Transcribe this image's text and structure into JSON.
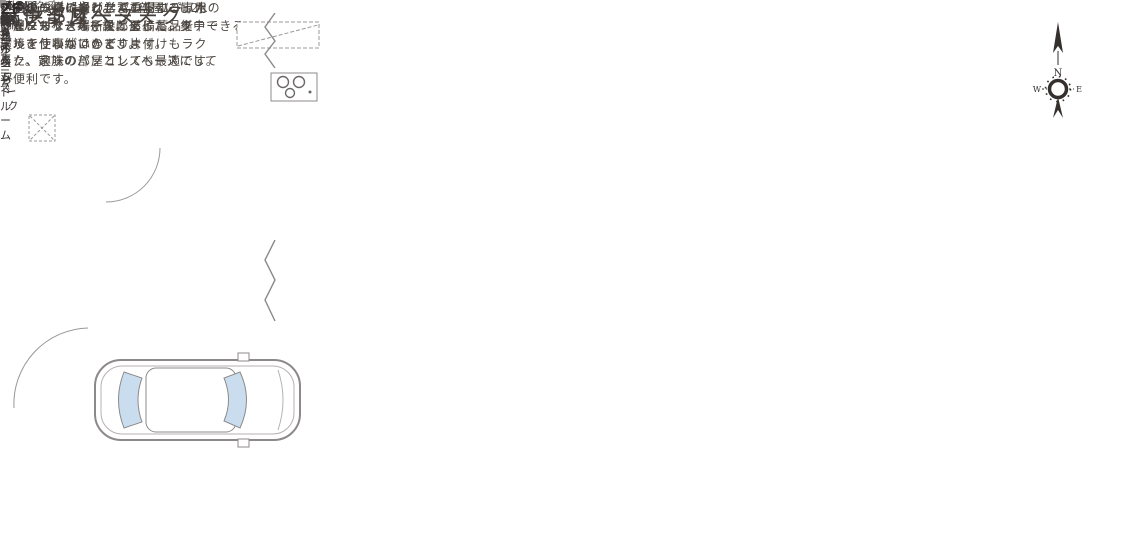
{
  "annotations": {
    "pantry": {
      "title": "パントリー",
      "desc": "キッチン横に設けたパントリー。水\nやビールなど場所をとる備蓄品を\nすっきり収納できます。"
    },
    "family_nook": {
      "title": "ファミリーヌーク",
      "desc": "お子様のリビング学習の場にぴった\nりなヌークスペース。ダイニングテー\nブルを使わないので、片付けもラク\nラク。家族のパソコンスペースにして\nも便利です。"
    },
    "kids_room": {
      "title": "子供部屋",
      "desc": "子供の成長に合わせて1部屋にも2\n部屋にもできる子供部屋。"
    },
    "workspace": {
      "title": "ワークスペース",
      "desc": "在宅ワークの場として重宝する専用の\nワークスペースを設けました。集中できる\n環境で仕事がはかどります。\nまた、趣味の部屋としても最適です。"
    }
  },
  "floor1": {
    "floor_label": "1F",
    "bathroom": "バスルーム",
    "storage_pantry": "収納",
    "storage_top": "収納",
    "storage_mid": "収納",
    "powder_room": "パウダー\nルーム",
    "toilet": "トイレ",
    "hall": "ホール",
    "up": "UP",
    "entrance": "玄関",
    "shoe_cloak": "シューズクローク",
    "ldk": "LDK",
    "ldk_size": "(14.6帖)",
    "family_nook": "ファミリー\nヌーク"
  },
  "floor2": {
    "floor_label": "2F",
    "workspace": "ワーク\nスペース",
    "toilet": "トイレ",
    "down": "DN",
    "wcl": "WCL",
    "wcl_size": "(3.5帖)",
    "bedroom_north": "ベッドルーム",
    "bedroom_north_size": "(5帖)",
    "closet_north": "CL",
    "bedroom_south": "ベッドルーム",
    "bedroom_south_size": "(5帖)",
    "closet_south": "CL",
    "master_bedroom": "マスターベッドルーム",
    "master_bedroom_size": "(7.3帖)",
    "balcony": "バルコニー"
  },
  "compass": {
    "north": "N",
    "west": "W",
    "east": "E"
  },
  "colors": {
    "accent_olive": "#6e7a2c",
    "wall_gray": "#6f6b6c",
    "text_dark": "#44403d",
    "closet_cream": "#f6ecd2"
  }
}
